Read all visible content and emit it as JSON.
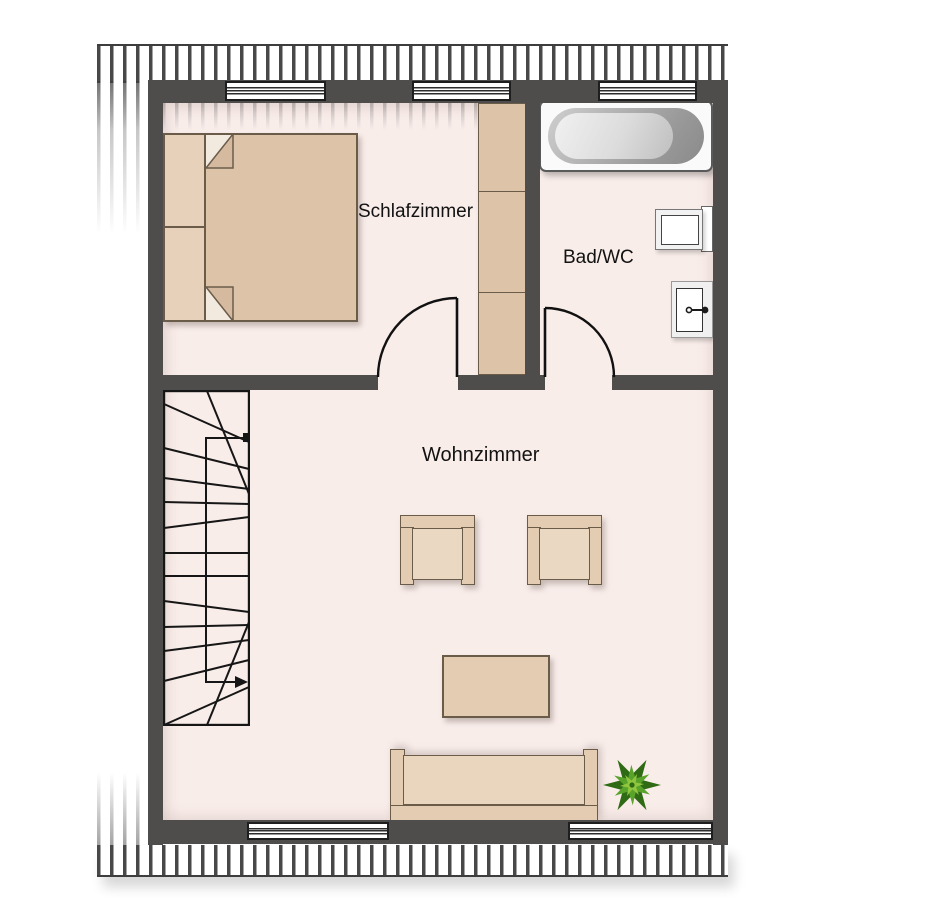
{
  "plan": {
    "rooms": [
      {
        "id": "schlafzimmer",
        "label": "Schlafzimmer",
        "furniture": [
          "double-bed",
          "wardrobe"
        ]
      },
      {
        "id": "bad-wc",
        "label": "Bad/WC",
        "furniture": [
          "bathtub",
          "toilet",
          "sink"
        ]
      },
      {
        "id": "wohnzimmer",
        "label": "Wohnzimmer",
        "furniture": [
          "armchair",
          "armchair",
          "coffee-table",
          "sofa",
          "plant",
          "staircase"
        ]
      }
    ],
    "features": {
      "windows_top": 3,
      "windows_bottom": 2,
      "doors": [
        "schlafzimmer-door",
        "bad-wc-door"
      ],
      "stairs": "winder-staircase-with-walkline-arrow",
      "roof_hatch": [
        "top-band",
        "bottom-band"
      ]
    }
  },
  "colors": {
    "wall": "#4f4d4b",
    "floor": "#f9edea",
    "furniture": "#e4ccb3",
    "furniture_border": "#6b5c4a",
    "mattress": "#ddc3a8",
    "tub_rim": "#8e8e8e",
    "plant_dark": "#2f6b15",
    "plant_mid": "#59a32b",
    "plant_light": "#8fc63e",
    "hatch": "#3e3e3e"
  }
}
